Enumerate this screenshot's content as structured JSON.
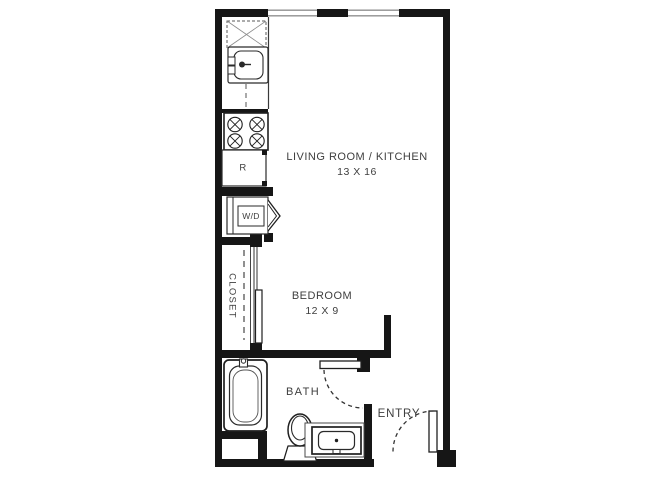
{
  "rooms": {
    "living_kitchen": {
      "label": "LIVING ROOM / KITCHEN",
      "dimensions": "13 X 16"
    },
    "bedroom": {
      "label": "BEDROOM",
      "dimensions": "12 X 9"
    },
    "bath": {
      "label": "BATH"
    },
    "entry": {
      "label": "ENTRY"
    },
    "closet": {
      "label": "CLOSET"
    }
  },
  "appliances": {
    "washer_dryer_label": "W/D",
    "refrigerator_label": "R"
  },
  "colors": {
    "wall": "#161616",
    "fixture_line": "#1f1f1f",
    "text": "#3e3e3e",
    "window_line": "#8f8f8f",
    "background": "#ffffff"
  }
}
